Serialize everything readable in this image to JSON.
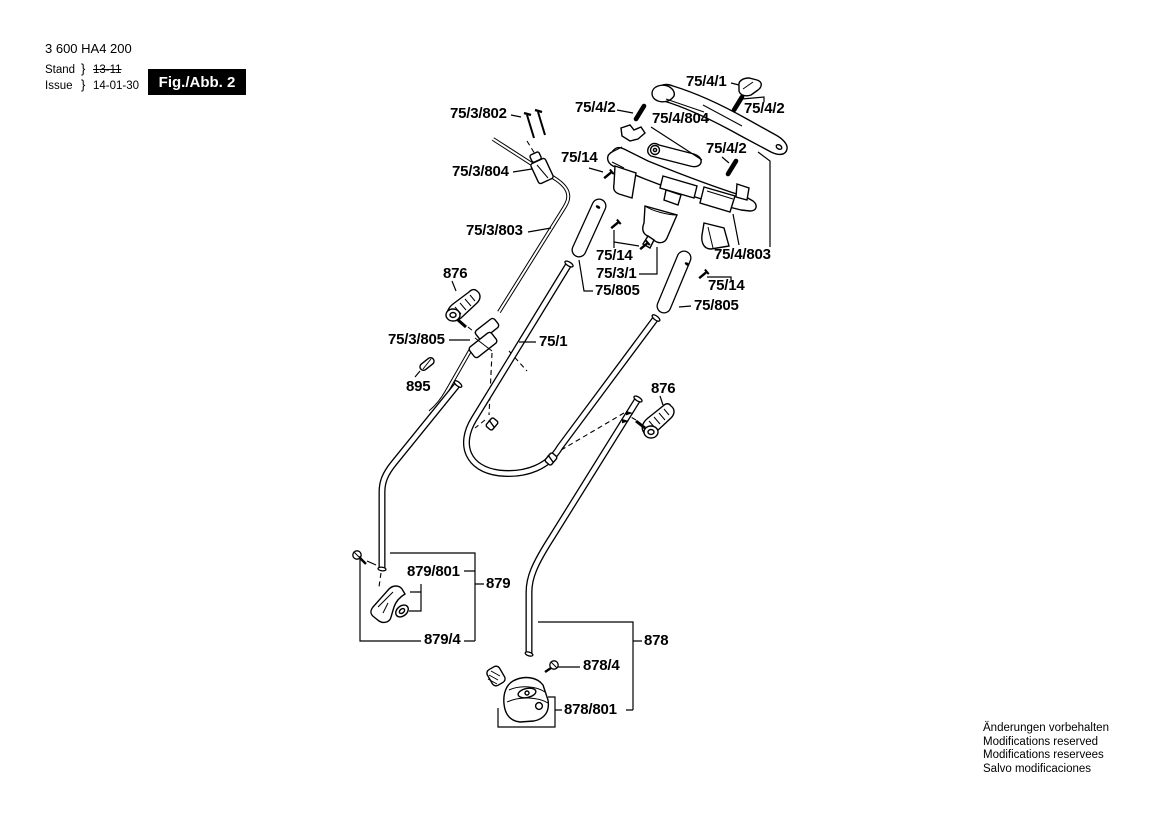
{
  "header": {
    "part_number": "3 600 HA4 200",
    "stand_label": "Stand",
    "issue_label": "Issue",
    "brace": "}",
    "stand_value": "13-11",
    "issue_value": "14-01-30",
    "figure_label": "Fig./Abb. 2"
  },
  "labels": [
    {
      "text": "75/4/1"
    },
    {
      "text": "75/4/2"
    },
    {
      "text": "75/4/2"
    },
    {
      "text": "75/4/804"
    },
    {
      "text": "75/3/802"
    },
    {
      "text": "75/14"
    },
    {
      "text": "75/4/2"
    },
    {
      "text": "75/3/804"
    },
    {
      "text": "75/3/803"
    },
    {
      "text": "75/14"
    },
    {
      "text": "75/3/1"
    },
    {
      "text": "75/805"
    },
    {
      "text": "75/4/803"
    },
    {
      "text": "75/14"
    },
    {
      "text": "75/805"
    },
    {
      "text": "876"
    },
    {
      "text": "75/3/805"
    },
    {
      "text": "75/1"
    },
    {
      "text": "895"
    },
    {
      "text": "876"
    },
    {
      "text": "879/801"
    },
    {
      "text": "879"
    },
    {
      "text": "879/4"
    },
    {
      "text": "878/4"
    },
    {
      "text": "878"
    },
    {
      "text": "878/801"
    }
  ],
  "footer_notes": [
    "Änderungen vorbehalten",
    "Modifications reserved",
    "Modifications reservees",
    "Salvo modificaciones"
  ],
  "colors": {
    "line": "#000000",
    "background": "#ffffff",
    "figure_box_bg": "#000000",
    "figure_box_text": "#ffffff"
  }
}
